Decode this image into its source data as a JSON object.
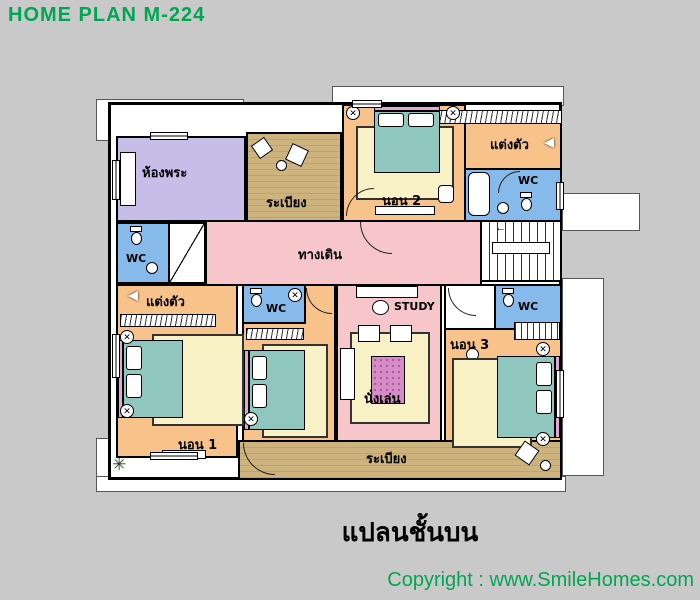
{
  "header": {
    "title": "HOME PLAN M-224"
  },
  "footer": {
    "caption": "แปลนชั้นบน",
    "copyright": "Copyright : www.SmileHomes.com"
  },
  "colors": {
    "background": "#C9C9C9",
    "wall": "#000000",
    "bedroom_fill": "#F7C38B",
    "corridor_fill": "#F7C6CB",
    "prayer_fill": "#C7BDE9",
    "wc_fill": "#85BAEB",
    "balcony_fill": "#CDB37E",
    "bed_fill": "#8FC7BF",
    "rug_fill": "#F8F2C6",
    "table_fill": "#D78CC8",
    "brand_text": "#00A651"
  },
  "rooms": {
    "prayer": {
      "label": "ห้องพระ"
    },
    "balcony_top": {
      "label": "ระเบียง"
    },
    "bedroom2": {
      "label": "นอน 2"
    },
    "dressing_top": {
      "label": "แต่งตัว"
    },
    "wc_top": {
      "label": "WC"
    },
    "corridor": {
      "label": "ทางเดิน"
    },
    "wc_left": {
      "label": "WC"
    },
    "dressing_left": {
      "label": "แต่งตัว"
    },
    "bedroom1": {
      "label": "นอน 1"
    },
    "wc_mid": {
      "label": "WC"
    },
    "study": {
      "label": "STUDY"
    },
    "sitting": {
      "label": "นั่งเล่น"
    },
    "bedroom3": {
      "label": "นอน 3"
    },
    "wc_right": {
      "label": "WC"
    },
    "balcony_bottom": {
      "label": "ระเบียง"
    }
  },
  "icons": {
    "fan_icon": "✕",
    "plant_icon": "✳",
    "stair_arrow_icon": "←"
  }
}
